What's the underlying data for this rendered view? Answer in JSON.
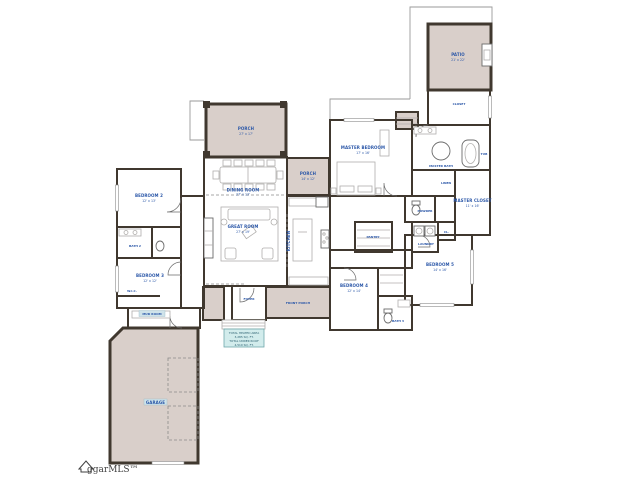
{
  "title": "residential floor plan",
  "logo": {
    "text": "ggarMLS™",
    "icon": "house-icon"
  },
  "colors": {
    "wall": "#40382f",
    "shaded_area": "#d9cfca",
    "label_blue": "#2b57a8",
    "note_fill": "#d2ecec",
    "highlight": "#cfe3ea",
    "background": "#ffffff"
  },
  "note_box": {
    "lines": [
      "TOTAL HEATED AREA",
      "3,285 SQ. FT.",
      "TOTAL UNDER ROOF",
      "4,510 SQ. FT."
    ]
  },
  "rooms": {
    "rear_porch": {
      "name": "PORCH",
      "dims": "27' x 17'"
    },
    "side_porch": {
      "name": "PORCH",
      "dims": "14' x 12'"
    },
    "patio": {
      "name": "PATIO",
      "dims": "21' x 22'"
    },
    "dining": {
      "name": "DINING ROOM",
      "dims": "27' x 13'"
    },
    "great_room": {
      "name": "GREAT ROOM",
      "dims": "27' x 19'"
    },
    "kitchen": {
      "name": "KITCHEN"
    },
    "pantry": {
      "name": "PANTRY"
    },
    "foyer": {
      "name": "FOYER"
    },
    "front_porch": {
      "name": "FRONT PORCH"
    },
    "master_bedroom": {
      "name": "MASTER BEDROOM",
      "dims": "17' x 16'"
    },
    "master_bath": {
      "name": "MASTER BATH"
    },
    "tub": {
      "name": "TUB"
    },
    "closet_tr": {
      "name": "CLOSET"
    },
    "master_closet": {
      "name": "MASTER CLOSET",
      "dims": "11' x 16'"
    },
    "linen": {
      "name": "LINEN"
    },
    "powder": {
      "name": "POWDER"
    },
    "laundry": {
      "name": "LAUNDRY"
    },
    "cl": {
      "name": "CL."
    },
    "bedroom2": {
      "name": "BEDROOM 2",
      "dims": "12' x 13'"
    },
    "bath2": {
      "name": "BATH 2"
    },
    "wic": {
      "name": "W.I.C."
    },
    "bedroom3": {
      "name": "BEDROOM 3",
      "dims": "12' x 12'"
    },
    "bedroom4": {
      "name": "BEDROOM 4",
      "dims": "12' x 14'"
    },
    "bath3": {
      "name": "BATH 3"
    },
    "bedroom5": {
      "name": "BEDROOM 5",
      "dims": "14' x 16'"
    },
    "mud": {
      "name": "MUD ROOM"
    },
    "garage": {
      "name": "GARAGE"
    }
  }
}
